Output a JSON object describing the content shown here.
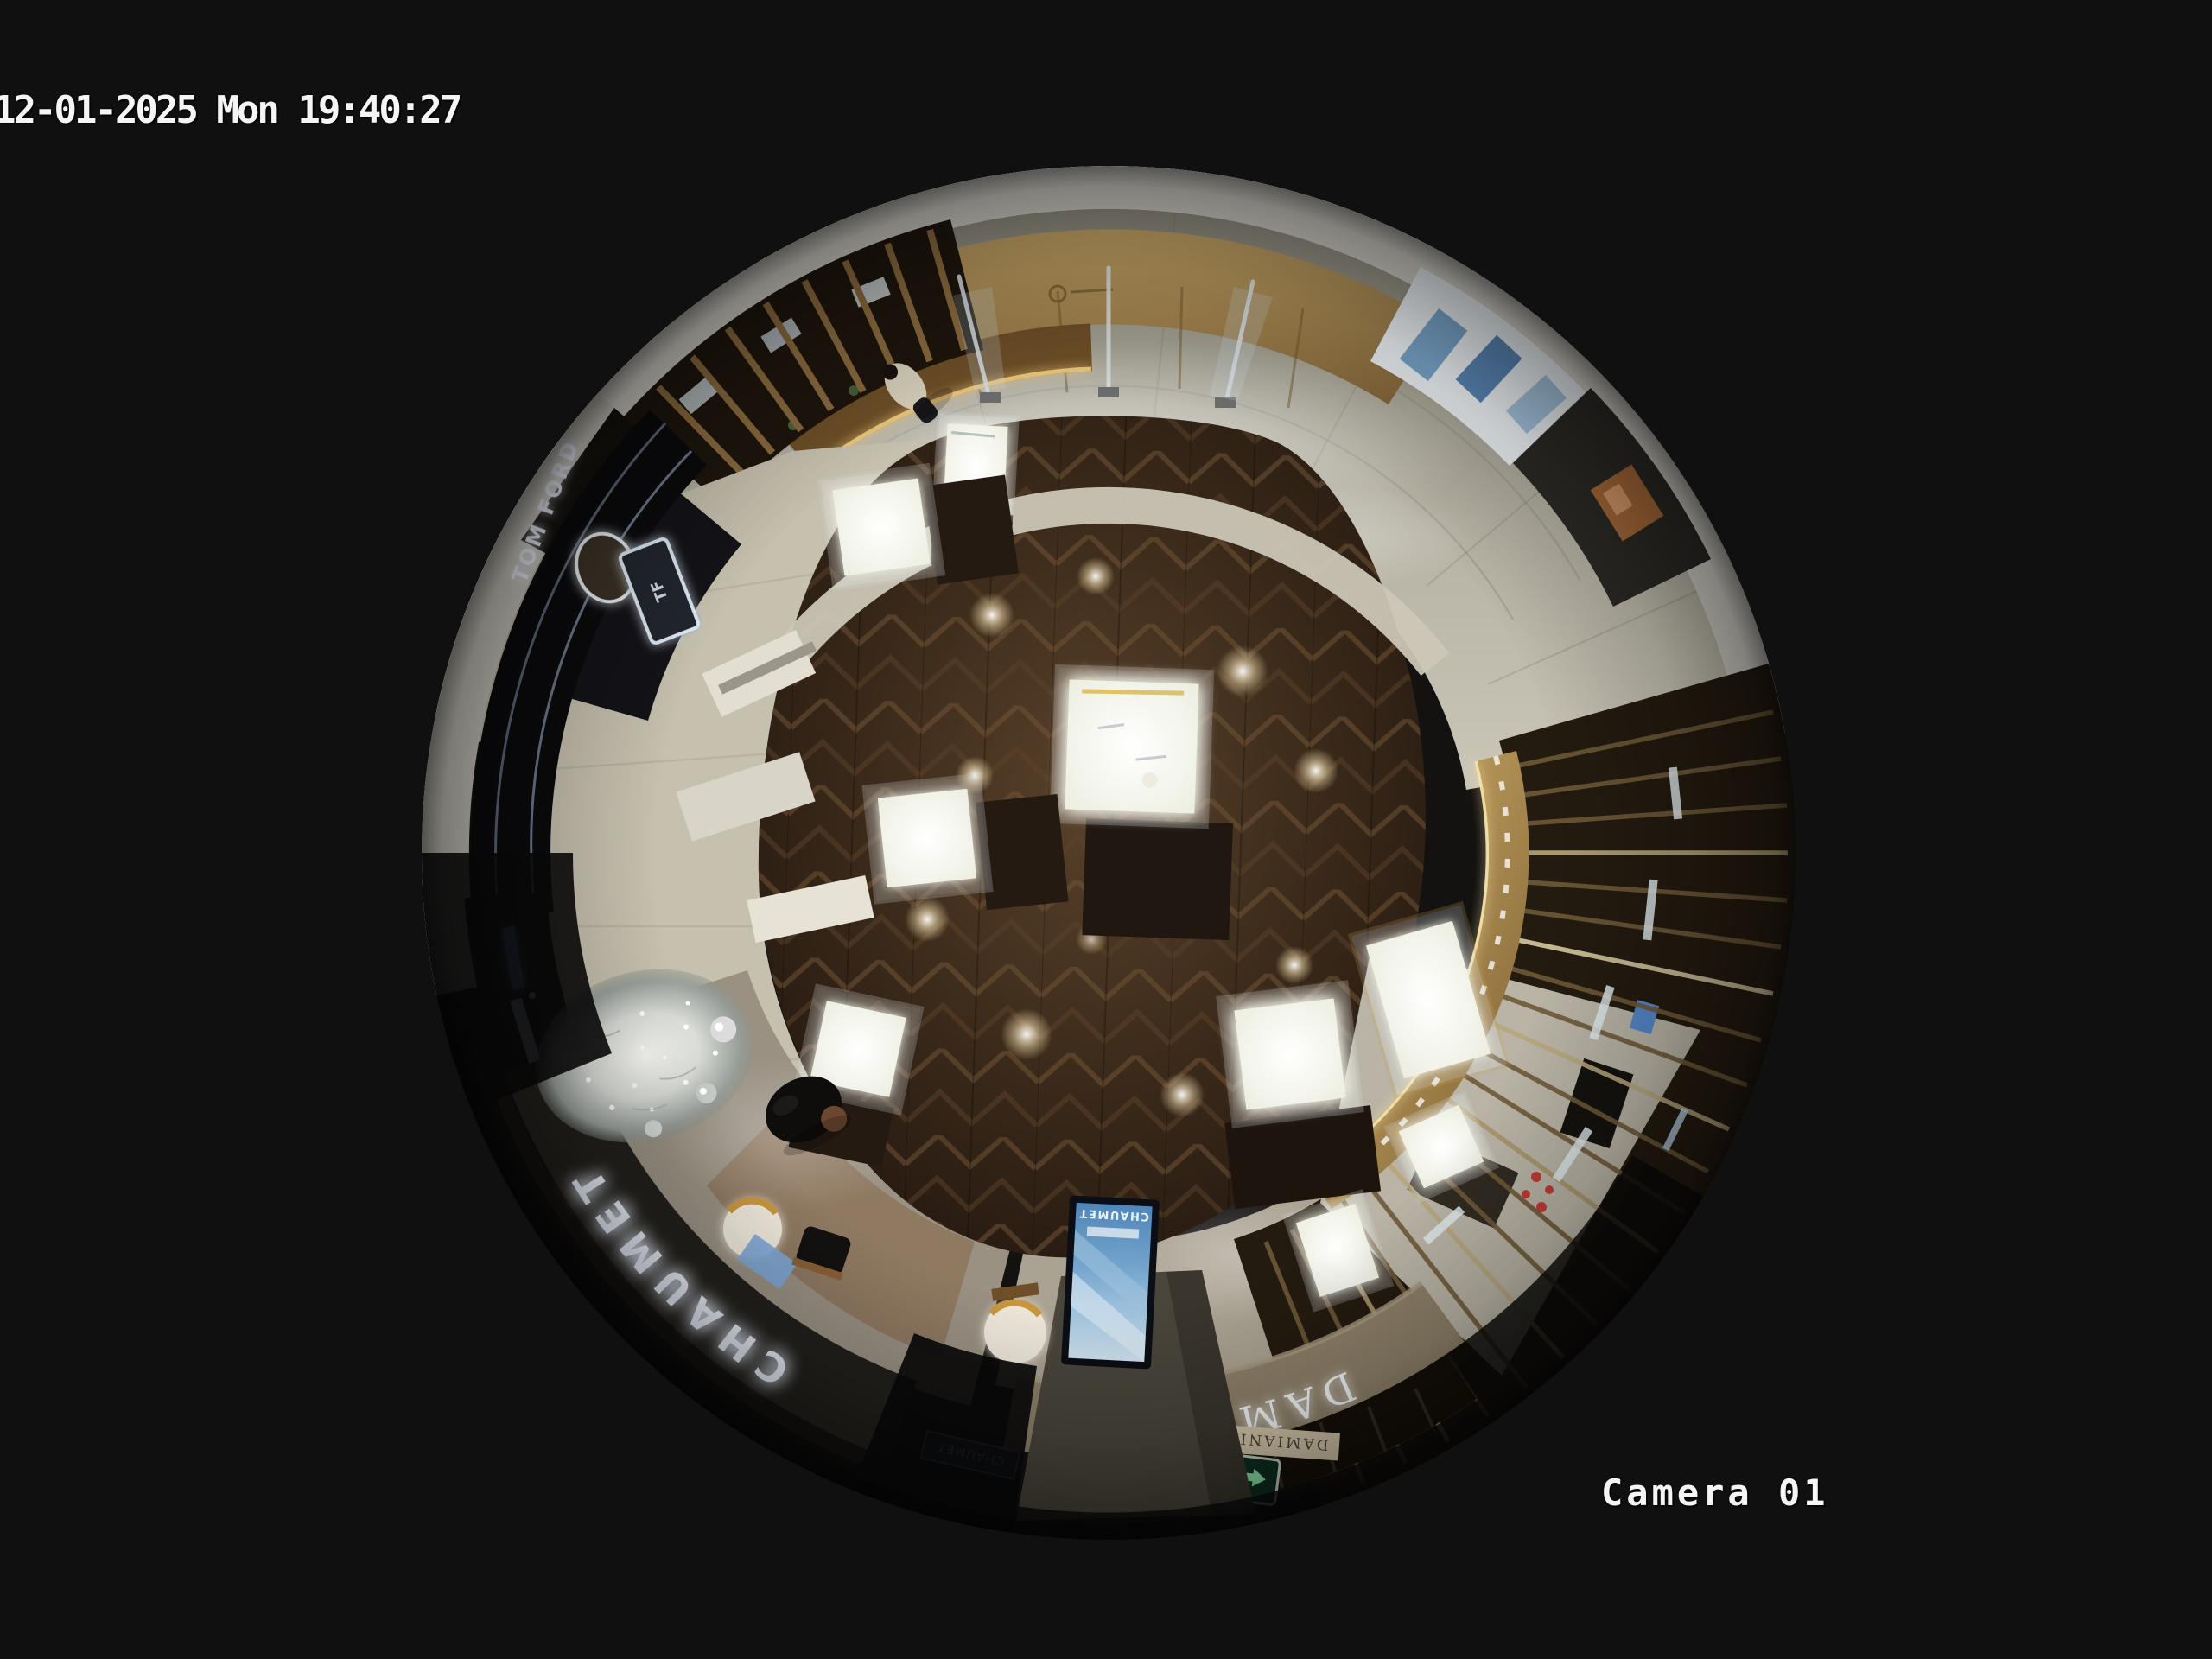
{
  "osd": {
    "timestamp": "12-01-2025 Mon 19:40:27",
    "camera_label": "Camera 01",
    "text_color": "#f5f5f5"
  },
  "scene": {
    "signs": {
      "tom_ford": "TOM FORD",
      "tf_monogram": "TF",
      "chaumet_fascia": "CHAUMET",
      "chaumet_screen": "CHAUMET",
      "chaumet_small": "CHAUMET",
      "damiani_fascia": "DAMIANI",
      "damiani_small": "DAMIANI",
      "exit_en": "EXIT",
      "exit_cn": "出口",
      "exit_full": "出口 EXIT"
    },
    "colors": {
      "background": "#101010",
      "wood_floor": "#3f2d1c",
      "marble_floor": "#b6b2a4",
      "ceiling": "#d8d6ce",
      "gold_wall": "#a8874e",
      "tom_ford_fascia": "#0b0b0d",
      "chaumet_fascia": "#23211d",
      "damiani_fascia": "#8e8169",
      "screen_blue": "#74a4cc",
      "exit_green": "#0e2f21",
      "tree_white": "#e8eae6",
      "case_glow": "#fbfbf3",
      "slat_wood": "#6e5a38"
    }
  }
}
